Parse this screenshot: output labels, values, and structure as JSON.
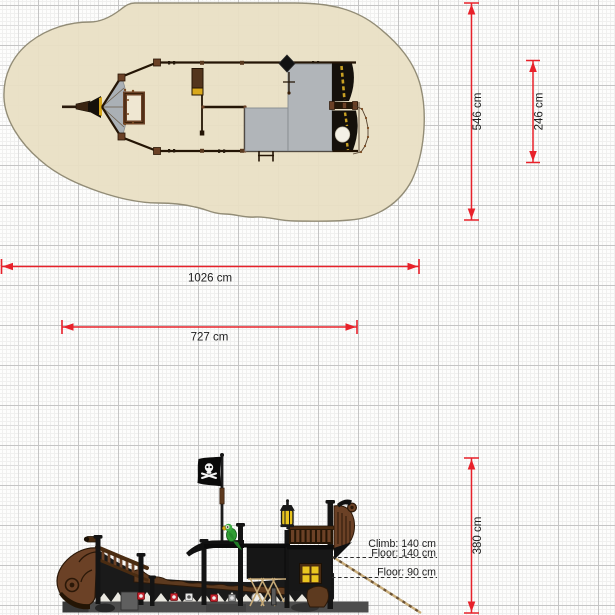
{
  "page": {
    "type": "playground equipment technical plan",
    "subject": "pirate ship play structure with safety zone",
    "views": {
      "top": "plan view with safety surfacing zone",
      "side": "side elevation"
    }
  },
  "colors": {
    "dimension_red": "#e8212a",
    "safety_zone_beige": "#e9dfc4",
    "deck_gray": "#b1b5b9",
    "wood_brown": "#6b4126",
    "hull_black": "#191919",
    "accent_yellow": "#e8c31e",
    "parrot_green": "#2f9e33"
  },
  "top_view": {
    "dimensions": [
      {
        "id": "safety-zone-length",
        "value": "1026 cm",
        "orientation": "horizontal"
      },
      {
        "id": "ship-length",
        "value": "727 cm",
        "orientation": "horizontal"
      },
      {
        "id": "safety-zone-width",
        "value": "546 cm",
        "orientation": "vertical"
      },
      {
        "id": "ship-width",
        "value": "246 cm",
        "orientation": "vertical"
      }
    ]
  },
  "side_view": {
    "dimensions": [
      {
        "id": "overall-height",
        "value": "380 cm",
        "orientation": "vertical"
      }
    ],
    "annotations": [
      {
        "id": "climb-height",
        "text": "Climb: 140 cm"
      },
      {
        "id": "upper-floor-height",
        "text": "Floor: 140 cm"
      },
      {
        "id": "lower-floor-height",
        "text": "Floor: 90 cm"
      }
    ],
    "features": [
      "pirate-flag",
      "parrot",
      "lantern",
      "portholes",
      "stern-window",
      "bow-scroll"
    ]
  }
}
